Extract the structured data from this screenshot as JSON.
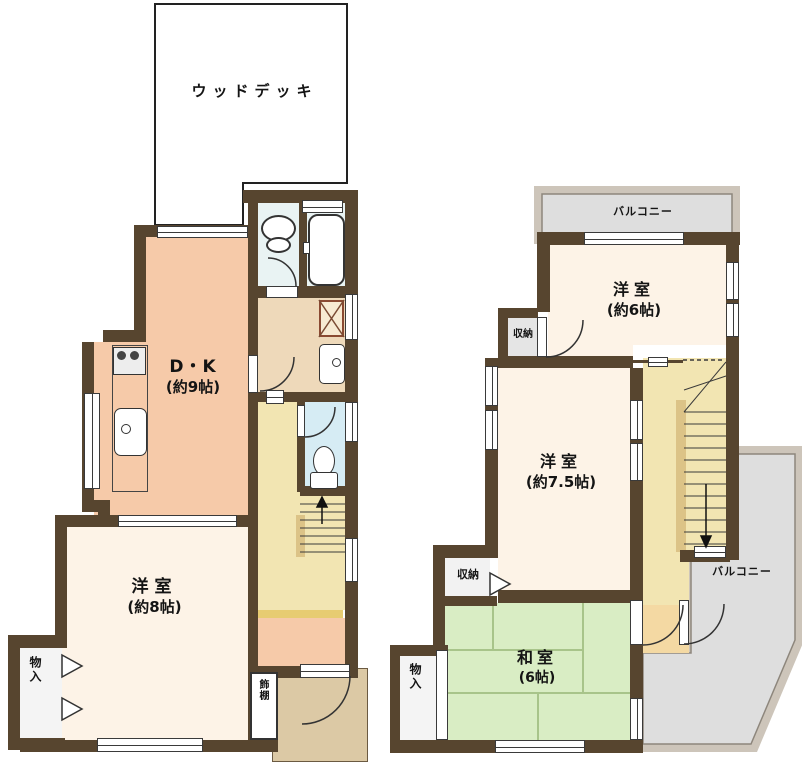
{
  "floor1": {
    "wood_deck": "ウッドデッキ",
    "dk": {
      "name": "D・K",
      "size": "(約9帖)"
    },
    "bedroom8": {
      "name": "洋室",
      "size": "(約8帖)"
    },
    "closet": "物入",
    "shelf": "飾棚"
  },
  "floor2": {
    "balcony_top": "バルコニー",
    "bedroom6": {
      "name": "洋室",
      "size": "(約6帖)"
    },
    "storage_upper": "収納",
    "bedroom75": {
      "name": "洋室",
      "size": "(約7.5帖)"
    },
    "storage_lower": "収納",
    "washitsu": {
      "name": "和室",
      "size": "(6帖)"
    },
    "closet": "物入",
    "balcony_side": "バルコニー"
  },
  "palette": {
    "wall": "#57452f",
    "dk_salmon": "#f6caa9",
    "bedroom_cream": "#fdf3e7",
    "hall_yellow": "#f2e5b2",
    "tatami_green": "#d9edc4",
    "toilet_blue": "#d6ecf4",
    "bath_blue": "#e9f3f3",
    "washroom_tan": "#eed9ba",
    "porch_tan": "#dcc9a5",
    "landing_orange": "#f4d9a3",
    "balcony_gray": "#dedede",
    "balcony_rim": "#cdc5ba",
    "step_gold": "#e7cc72",
    "rail_tan": "#dcc387"
  }
}
